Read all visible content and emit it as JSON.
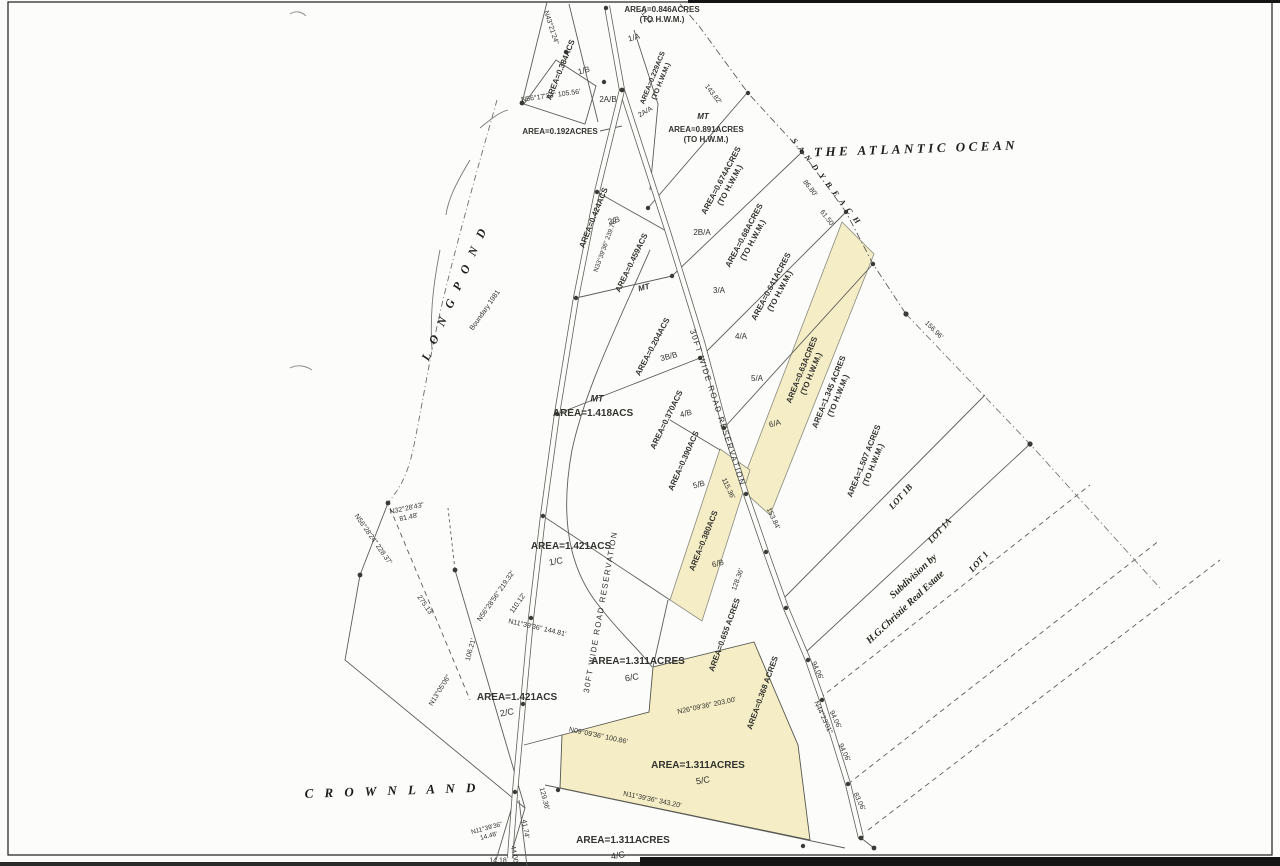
{
  "map": {
    "type": "scanned-subdivision-survey-plat",
    "colors": {
      "highlight": "#f4edc5",
      "ink": "#30302e",
      "line": "#5c5c58"
    },
    "labels": [
      {
        "n": "ocean-label",
        "t": "THE ATLANTIC OCEAN",
        "x": 916,
        "y": 149,
        "r": -2,
        "s": 13,
        "ls": 3.5,
        "cls": "place"
      },
      {
        "n": "sandy-beach-label",
        "t": "S A N D Y   B E A C H",
        "x": 826,
        "y": 182,
        "r": 52,
        "s": 8,
        "ls": 2,
        "cls": "place"
      },
      {
        "n": "long-pond-label",
        "t": "L O N G   P O N D",
        "x": 455,
        "y": 293,
        "r": -66,
        "s": 12,
        "ls": 4,
        "cls": "place"
      },
      {
        "n": "crown-land-label",
        "t": "C R O W N   L A N D",
        "x": 392,
        "y": 791,
        "r": -2,
        "s": 13,
        "ls": 4,
        "cls": "place"
      },
      {
        "n": "subdivision-label-line1",
        "t": "Subdivision  by",
        "x": 914,
        "y": 577,
        "r": -43,
        "s": 10,
        "cls": "lot"
      },
      {
        "n": "subdivision-label-line2",
        "t": "H.G.Christie  Real  Estate",
        "x": 906,
        "y": 608,
        "r": -43,
        "s": 10,
        "cls": "lot"
      },
      {
        "n": "parcel-area",
        "t": "AREA=0.846ACRES\n(TO H.W.M.)",
        "x": 662,
        "y": 15,
        "r": 0,
        "s": 8,
        "cls": "area"
      },
      {
        "n": "parcel-id",
        "t": "1/A",
        "x": 634,
        "y": 38,
        "r": -15,
        "s": 8
      },
      {
        "n": "parcel-area",
        "t": "AREA=0.384ACS",
        "x": 561,
        "y": 70,
        "r": -68,
        "s": 8,
        "cls": "area"
      },
      {
        "n": "parcel-id",
        "t": "1/B",
        "x": 584,
        "y": 71,
        "r": -15,
        "s": 8
      },
      {
        "n": "parcel-area",
        "t": "AREA=0.229ACS\n(TO H.W.M.)",
        "x": 658,
        "y": 80,
        "r": -68,
        "s": 7,
        "cls": "area"
      },
      {
        "n": "parcel-id",
        "t": "2A/B",
        "x": 608,
        "y": 100,
        "r": 0,
        "s": 8
      },
      {
        "n": "parcel-id",
        "t": "2A/A",
        "x": 646,
        "y": 113,
        "r": -30,
        "s": 7
      },
      {
        "n": "parcel-area",
        "t": "AREA=0.192ACRES",
        "x": 560,
        "y": 132,
        "r": 0,
        "s": 8,
        "cls": "area"
      },
      {
        "n": "parcel-id",
        "t": "MT",
        "x": 703,
        "y": 117,
        "r": 0,
        "s": 8,
        "cls": "mt"
      },
      {
        "n": "parcel-area",
        "t": "AREA=0.891ACRES\n(TO H.W.M.)",
        "x": 706,
        "y": 135,
        "r": 0,
        "s": 8,
        "cls": "area"
      },
      {
        "n": "bearing-label",
        "t": "N56°17'33\"  105.56'",
        "x": 551,
        "y": 97,
        "r": -8,
        "s": 7
      },
      {
        "n": "bearing-label",
        "t": "N43°21'24\"",
        "x": 550,
        "y": 28,
        "r": 72,
        "s": 7
      },
      {
        "n": "distance-label",
        "t": "71.13'",
        "x": 645,
        "y": 17,
        "r": 50,
        "s": 7
      },
      {
        "n": "distance-label",
        "t": "143.82'",
        "x": 712,
        "y": 95,
        "r": 52,
        "s": 7
      },
      {
        "n": "distance-label",
        "t": "86.80'",
        "x": 809,
        "y": 189,
        "r": 52,
        "s": 7
      },
      {
        "n": "distance-label",
        "t": "61.50'",
        "x": 826,
        "y": 219,
        "r": 52,
        "s": 7
      },
      {
        "n": "parcel-area",
        "t": "AREA=0.674ACRES\n(TO H.W.M.)",
        "x": 726,
        "y": 183,
        "r": -62,
        "s": 8,
        "cls": "area"
      },
      {
        "n": "parcel-id",
        "t": "2B/A",
        "x": 702,
        "y": 233,
        "r": 0,
        "s": 8
      },
      {
        "n": "parcel-area",
        "t": "AREA=0.424ACS",
        "x": 594,
        "y": 218,
        "r": -68,
        "s": 8,
        "cls": "area"
      },
      {
        "n": "parcel-id",
        "t": "2/B",
        "x": 614,
        "y": 221,
        "r": -15,
        "s": 8
      },
      {
        "n": "bearing-label",
        "t": "N33°39'36\"  239.76'",
        "x": 606,
        "y": 246,
        "r": -70,
        "s": 6.5
      },
      {
        "n": "parcel-area",
        "t": "AREA=0.68ACRES\n(TO H.W.M.)",
        "x": 749,
        "y": 238,
        "r": -62,
        "s": 8,
        "cls": "area"
      },
      {
        "n": "parcel-id",
        "t": "3/A",
        "x": 719,
        "y": 291,
        "r": 0,
        "s": 8
      },
      {
        "n": "parcel-area",
        "t": "AREA=0.459ACS",
        "x": 632,
        "y": 263,
        "r": -64,
        "s": 8,
        "cls": "area"
      },
      {
        "n": "parcel-id",
        "t": "MT",
        "x": 644,
        "y": 288,
        "r": -15,
        "s": 8,
        "cls": "mt"
      },
      {
        "n": "parcel-area",
        "t": "AREA=0.641ACRES\n(TO H.W.M.)",
        "x": 776,
        "y": 289,
        "r": -62,
        "s": 8,
        "cls": "area"
      },
      {
        "n": "parcel-id",
        "t": "4/A",
        "x": 741,
        "y": 337,
        "r": 0,
        "s": 8
      },
      {
        "n": "parcel-area",
        "t": "AREA=0.204ACS",
        "x": 653,
        "y": 347,
        "r": -62,
        "s": 8,
        "cls": "area"
      },
      {
        "n": "parcel-id",
        "t": "3B/B",
        "x": 669,
        "y": 357,
        "r": -15,
        "s": 8
      },
      {
        "n": "road-a-label",
        "t": "30FT  WIDE  ROAD  RESERVATION",
        "x": 717,
        "y": 408,
        "r": 72,
        "s": 8,
        "ls": 1.5
      },
      {
        "n": "parcel-id",
        "t": "4/B",
        "x": 686,
        "y": 414,
        "r": -15,
        "s": 8
      },
      {
        "n": "parcel-area",
        "t": "AREA=0.370ACS",
        "x": 667,
        "y": 420,
        "r": -64,
        "s": 8,
        "cls": "area"
      },
      {
        "n": "parcel-id",
        "t": "MT",
        "x": 597,
        "y": 399,
        "r": 0,
        "s": 9,
        "cls": "mt"
      },
      {
        "n": "parcel-area",
        "t": "AREA=1.418ACS",
        "x": 593,
        "y": 414,
        "r": 0,
        "s": 10,
        "cls": "area"
      },
      {
        "n": "parcel-area",
        "t": "AREA=0.63ACRES\n(TO H.W.M.)",
        "x": 807,
        "y": 372,
        "r": -68,
        "s": 8,
        "cls": "area"
      },
      {
        "n": "parcel-id",
        "t": "5/A",
        "x": 757,
        "y": 379,
        "r": 0,
        "s": 8
      },
      {
        "n": "parcel-id",
        "t": "6/A",
        "x": 775,
        "y": 424,
        "r": -15,
        "s": 8
      },
      {
        "n": "parcel-area",
        "t": "AREA=1.345 ACRES\n(TO H.W.M.)",
        "x": 834,
        "y": 394,
        "r": -68,
        "s": 8,
        "cls": "area"
      },
      {
        "n": "parcel-area",
        "t": "AREA=1.507 ACRES\n(TO H.W.M.)",
        "x": 869,
        "y": 463,
        "r": -68,
        "s": 8,
        "cls": "area"
      },
      {
        "n": "lot-label",
        "t": "LOT  1B",
        "x": 901,
        "y": 497,
        "r": -48,
        "s": 9,
        "cls": "lot"
      },
      {
        "n": "lot-label",
        "t": "LOT  1A",
        "x": 940,
        "y": 531,
        "r": -48,
        "s": 9,
        "cls": "lot"
      },
      {
        "n": "lot-label",
        "t": "LOT  1",
        "x": 979,
        "y": 562,
        "r": -48,
        "s": 9,
        "cls": "lot"
      },
      {
        "n": "distance-label",
        "t": "156.96'",
        "x": 933,
        "y": 331,
        "r": 45,
        "s": 7
      },
      {
        "n": "parcel-area",
        "t": "AREA=0.390ACS",
        "x": 684,
        "y": 461,
        "r": -66,
        "s": 8,
        "cls": "area"
      },
      {
        "n": "parcel-id",
        "t": "5/B",
        "x": 699,
        "y": 485,
        "r": -15,
        "s": 8
      },
      {
        "n": "parcel-area",
        "t": "AREA=0.380ACS",
        "x": 704,
        "y": 541,
        "r": -68,
        "s": 8,
        "cls": "area"
      },
      {
        "n": "parcel-id",
        "t": "6/B",
        "x": 718,
        "y": 564,
        "r": -15,
        "s": 8
      },
      {
        "n": "parcel-area",
        "t": "AREA=1.421ACS",
        "x": 571,
        "y": 547,
        "r": 0,
        "s": 10,
        "cls": "area"
      },
      {
        "n": "parcel-id",
        "t": "1/C",
        "x": 556,
        "y": 562,
        "r": -10,
        "s": 9
      },
      {
        "n": "bearing-label",
        "t": "N56°28'24\"  228.37'",
        "x": 372,
        "y": 540,
        "r": 55,
        "s": 7
      },
      {
        "n": "bearing-label",
        "t": "N32°28'43\"\n81.48'",
        "x": 408,
        "y": 514,
        "r": -12,
        "s": 7
      },
      {
        "n": "distance-label",
        "t": "275.13'",
        "x": 424,
        "y": 606,
        "r": 55,
        "s": 7
      },
      {
        "n": "bearing-label",
        "t": "N56°28'56\"  219.32'",
        "x": 497,
        "y": 597,
        "r": -55,
        "s": 7
      },
      {
        "n": "distance-label",
        "t": "110.12'",
        "x": 519,
        "y": 604,
        "r": -55,
        "s": 7
      },
      {
        "n": "distance-label",
        "t": "106.21'",
        "x": 472,
        "y": 650,
        "r": -75,
        "s": 7
      },
      {
        "n": "bearing-label",
        "t": "N13°05'06\"",
        "x": 441,
        "y": 691,
        "r": -58,
        "s": 7
      },
      {
        "n": "road-b-label",
        "t": "30FT  WIDE  ROAD  RESERVATION",
        "x": 601,
        "y": 612,
        "r": -80,
        "s": 8,
        "ls": 1.5
      },
      {
        "n": "bearing-label",
        "t": "N11°39'36\"  144.81'",
        "x": 537,
        "y": 629,
        "r": 13,
        "s": 7
      },
      {
        "n": "boundary-note",
        "t": "Boundary  1981",
        "x": 486,
        "y": 311,
        "r": -55,
        "s": 7
      },
      {
        "n": "parcel-area",
        "t": "AREA=1.311ACRES",
        "x": 638,
        "y": 662,
        "r": 0,
        "s": 10,
        "cls": "area"
      },
      {
        "n": "parcel-id",
        "t": "6/C",
        "x": 632,
        "y": 678,
        "r": -10,
        "s": 9
      },
      {
        "n": "parcel-area",
        "t": "AREA=0.655 ACRES",
        "x": 725,
        "y": 635,
        "r": -70,
        "s": 8,
        "cls": "area"
      },
      {
        "n": "parcel-area",
        "t": "AREA=0.368 ACRES",
        "x": 763,
        "y": 693,
        "r": -70,
        "s": 8,
        "cls": "area"
      },
      {
        "n": "distance-label",
        "t": "128.36'",
        "x": 739,
        "y": 580,
        "r": -70,
        "s": 7
      },
      {
        "n": "distance-label",
        "t": "115.36'",
        "x": 727,
        "y": 489,
        "r": 65,
        "s": 7
      },
      {
        "n": "distance-label",
        "t": "153.84'",
        "x": 772,
        "y": 519,
        "r": 65,
        "s": 7
      },
      {
        "n": "parcel-area",
        "t": "AREA=1.421ACS",
        "x": 517,
        "y": 698,
        "r": 0,
        "s": 10,
        "cls": "area"
      },
      {
        "n": "parcel-id",
        "t": "2/C",
        "x": 507,
        "y": 713,
        "r": -10,
        "s": 9
      },
      {
        "n": "bearing-label",
        "t": "N26°09'36\"  203.00'",
        "x": 707,
        "y": 707,
        "r": -12,
        "s": 7
      },
      {
        "n": "bearing-label",
        "t": "N09°09'36\"  100.86'",
        "x": 598,
        "y": 737,
        "r": 12,
        "s": 7
      },
      {
        "n": "parcel-area",
        "t": "AREA=1.311ACRES",
        "x": 698,
        "y": 766,
        "r": 0,
        "s": 10,
        "cls": "area"
      },
      {
        "n": "parcel-id",
        "t": "5/C",
        "x": 703,
        "y": 781,
        "r": -10,
        "s": 9
      },
      {
        "n": "bearing-label",
        "t": "N11°39'36\"  343.20'",
        "x": 652,
        "y": 801,
        "r": 12,
        "s": 7
      },
      {
        "n": "distance-label",
        "t": "94.06'",
        "x": 816,
        "y": 671,
        "r": 65,
        "s": 7
      },
      {
        "n": "bearing-label",
        "t": "N44°23'01\"",
        "x": 822,
        "y": 718,
        "r": 65,
        "s": 7
      },
      {
        "n": "distance-label",
        "t": "94.06'",
        "x": 834,
        "y": 720,
        "r": 65,
        "s": 7
      },
      {
        "n": "distance-label",
        "t": "94.06'",
        "x": 843,
        "y": 753,
        "r": 65,
        "s": 7
      },
      {
        "n": "distance-label",
        "t": "83.06'",
        "x": 858,
        "y": 802,
        "r": 65,
        "s": 7
      },
      {
        "n": "parcel-area",
        "t": "AREA=1.311ACRES",
        "x": 623,
        "y": 841,
        "r": 0,
        "s": 10,
        "cls": "area"
      },
      {
        "n": "parcel-id",
        "t": "4/C",
        "x": 618,
        "y": 856,
        "r": -10,
        "s": 9
      },
      {
        "n": "distance-label",
        "t": "129.36'",
        "x": 543,
        "y": 799,
        "r": 75,
        "s": 7
      },
      {
        "n": "distance-label",
        "t": "41.74'",
        "x": 524,
        "y": 829,
        "r": 80,
        "s": 7
      },
      {
        "n": "bearing-label",
        "t": "N11°39'36\"\n14.48'",
        "x": 488,
        "y": 833,
        "r": -15,
        "s": 6.5
      },
      {
        "n": "distance-label",
        "t": "44.00'",
        "x": 513,
        "y": 855,
        "r": 80,
        "s": 7
      },
      {
        "n": "distance-label",
        "t": "14.18",
        "x": 498,
        "y": 862,
        "r": 0,
        "s": 7
      }
    ]
  }
}
